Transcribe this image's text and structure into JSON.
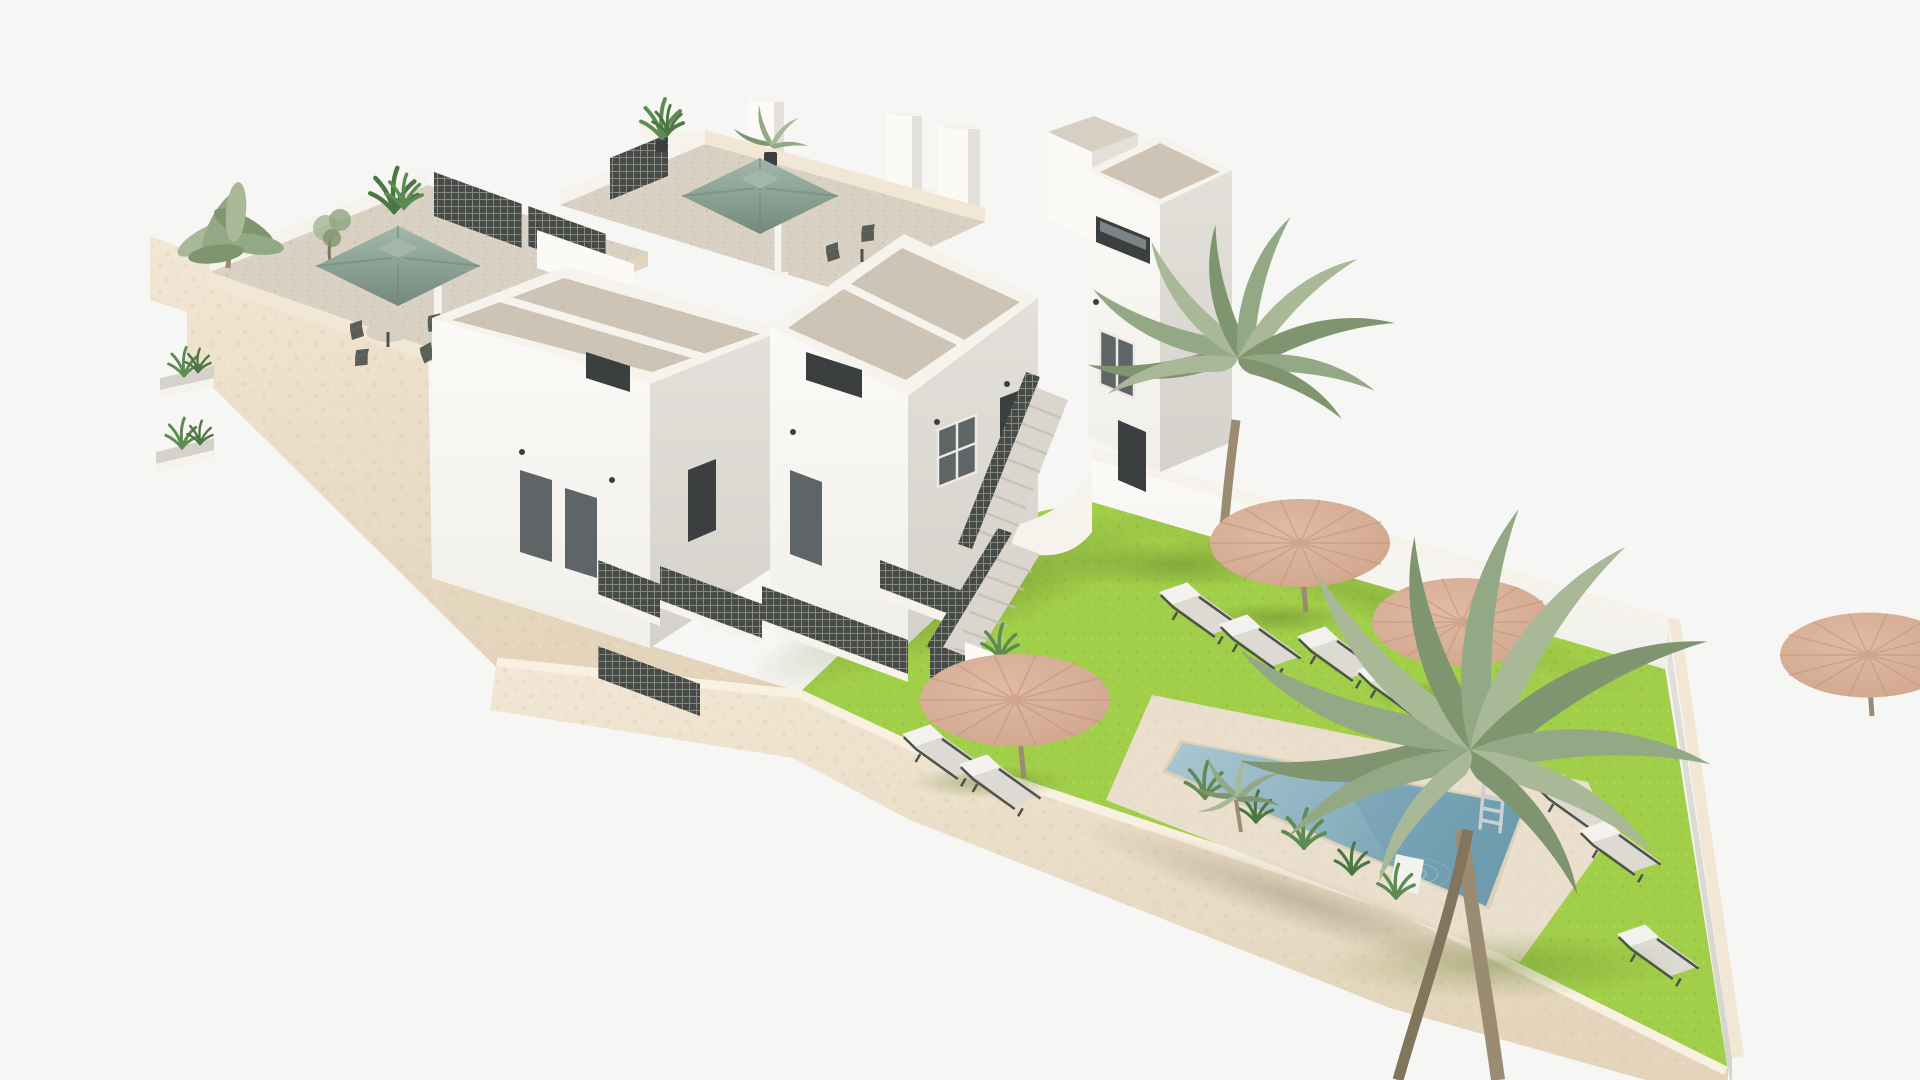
{
  "scene": {
    "type": "3d-architectural-render",
    "subject": "Aerial 3D render of a modern white Mediterranean apartment complex with rooftop terraces, communal lawn garden, swimming pool, straw parasols, sun loungers and palm trees on a plain pale background",
    "view": "isometric-style aerial exterior visualization, long diagonal plot from upper-left (buildings) to lower-right (pool garden)",
    "inventory": {
      "residential_blocks": 4,
      "rooftop_terraces": 2,
      "sage_square_umbrellas": 2,
      "rooftop_dining_sets": 2,
      "straw_garden_parasols": 4,
      "sun_loungers": 9,
      "large_palm_trees": 2,
      "small_palms": 2,
      "swimming_pools": 1,
      "pool_ladders": 1,
      "pool_entry_steps": 1,
      "external_staircases": 1,
      "chimney_stacks": 4,
      "balcony_levels": 2,
      "side_wall_planter_balconies": 2,
      "wall_lamps": 8
    }
  },
  "colors": {
    "bg": "#f6f6f4",
    "creamLight": "#f2e7d5",
    "creamDark": "#e3d4bb",
    "creamCap": "#f8f1e2",
    "whiteSun": "#fbfaf7",
    "whiteSoft": "#f1efe9",
    "faceShade": "#e2e0d9",
    "faceShade2": "#d4d2cb",
    "roofFloor": "#cdc4b6",
    "roofFloor2": "#d7cfc2",
    "parapet": "#f6f3ec",
    "terraceFloor": "#d8d1c4",
    "windowDark": "#3b3f40",
    "glass": "#5f6567",
    "glassLight": "#7d8487",
    "frameWhite": "#eceae3",
    "lattice": "#474b47",
    "stairFill": "#dad6ce",
    "stairShade": "#c2beb5",
    "lawn": "#a2cf4a",
    "lawnLight": "#aeda58",
    "lawnShade": "#8fbf3c",
    "deck": "#eadfcc",
    "deckShade": "#dcd0b8",
    "waterLight": "#aac7d2",
    "water": "#8db2c1",
    "waterDeep": "#6f9cae",
    "straw": "#e2bba4",
    "strawShade": "#cfa58c",
    "strawStreak": "#c2977e",
    "sage": "#8ba294",
    "sageLight": "#a3b7a9",
    "sageDark": "#75897b",
    "lounger": "#f3f2ee",
    "loungerShade": "#dcdad3",
    "metal": "#4e524d",
    "palm1": "#93a884",
    "palm2": "#7f956f",
    "palm3": "#a9b896",
    "trunk": "#9b8b72",
    "trunkDark": "#83745d",
    "plantGreen": "#5e8b53",
    "plantDark": "#4c7644",
    "ladder": "#c9cfd2",
    "poolStep": "#f2f2ee"
  }
}
